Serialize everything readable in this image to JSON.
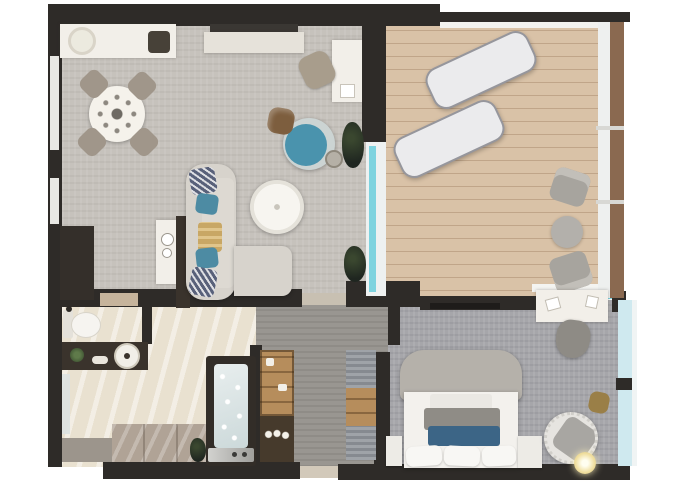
{
  "title": "Apartment suite 3D floor plan, top view",
  "colors": {
    "background": "#ffffff",
    "wall": "#2e2b28",
    "carpet_living": "#c6c2bc",
    "carpet_bedroom": "#a6a6aa",
    "carpet_corridor": "#999691",
    "terrace_wood": "#d9c2a7",
    "bath_marble": "#e9e1d0",
    "bath_marble_dark": "#b0a396",
    "glass_teal": "#7ed3df",
    "glass_blue": "#cfe9ef",
    "accent_teal_chair": "#4a93ad",
    "wardrobe_wood": "#b68d5c",
    "railing_wood": "#8a6950",
    "gold_table": "#9a7f47"
  },
  "rooms": {
    "living_dining": {
      "label": "Living and dining room",
      "items": {
        "kitchen_counter": "Kitchen counter with round sink and hob",
        "tv": "Wall-mounted TV",
        "media_console": "Media console",
        "dining_table": "Round dining table with patterned top",
        "dining_chair": "Dining chair",
        "desk": "Writing desk",
        "desk_chair": "Desk chair",
        "sofa": "L-shaped sofa with accent pillows",
        "coffee_table": "Round coffee table",
        "console": "Console table with decorative plates",
        "armchair": "Teal swivel armchair",
        "side_table": "Metal side table",
        "pouf": "Leather pouf",
        "plant": "Potted plant",
        "cabinet": "Tall dark cabinet",
        "partition": "Partition wall behind sofa"
      }
    },
    "terrace": {
      "label": "Terrace with wood deck",
      "items": {
        "lounger": "Sun lounger",
        "chair": "Outdoor chair",
        "table": "Round outdoor table",
        "railing": "Glass railing with wood frame",
        "glass_door": "Sliding glass door to living room"
      }
    },
    "bedroom": {
      "label": "Bedroom",
      "items": {
        "bed": "Double bed with curved upholstered headboard",
        "pillow": "Bed pillow",
        "throw_blue": "Blue folded throw",
        "throw_gray": "Gray folded throw",
        "throw_white": "White folded linen",
        "nightstand": "Nightstand",
        "desk": "Desk under terrace window",
        "desk_chair": "Desk chair",
        "armchair": "Round boucle lounge chair",
        "floor_lamp": "Glowing floor lamp",
        "gold_table": "Brass side table",
        "tv": "Wall-mounted TV",
        "glass_wall": "Floor-to-ceiling glazing",
        "window": "Window strip to terrace"
      }
    },
    "bathroom": {
      "label": "Bathroom",
      "items": {
        "toilet": "Toilet",
        "vanity": "Dark vanity with round vessel sink",
        "sink": "Round vessel sink",
        "plant": "Green plant",
        "soap": "Toiletries tray",
        "shower": "Walk-in shower with glass screen",
        "bathtub": "Built-in bathtub with water",
        "tub_deck": "Chrome tub deck with taps",
        "door": "Bathroom door leaf"
      }
    },
    "corridor": {
      "label": "Wardrobe corridor",
      "items": {
        "wardrobe_open": "Open wardrobe with wooden shelves",
        "chest": "Dark chest with decor objects",
        "wardrobe_right": "Wardrobe with louvered doors",
        "entry": "Entry door threshold"
      }
    }
  }
}
